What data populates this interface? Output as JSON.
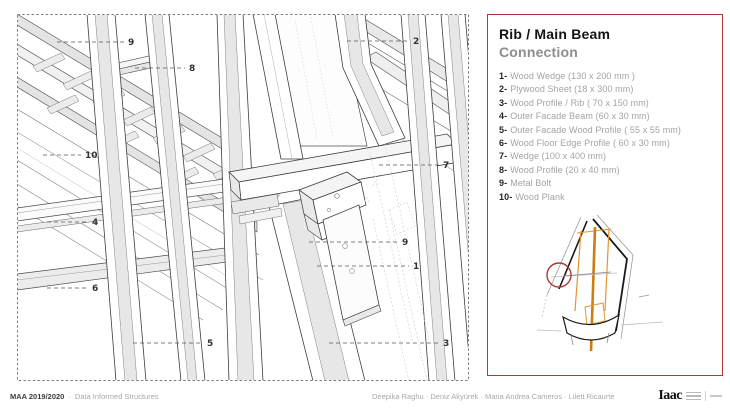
{
  "colors": {
    "accent_red": "#ae3a34",
    "orange": "#e2952f",
    "orange_dark": "#cf7d12"
  },
  "drawing": {
    "callouts": [
      {
        "label": "9",
        "x": 111,
        "y": 28,
        "leader_from": 40
      },
      {
        "label": "8",
        "x": 172,
        "y": 54,
        "leader_from": 118
      },
      {
        "label": "2",
        "x": 396,
        "y": 27,
        "leader_from": 330
      },
      {
        "label": "10",
        "x": 68,
        "y": 141,
        "leader_from": 26
      },
      {
        "label": "7",
        "x": 426,
        "y": 151,
        "leader_from": 362
      },
      {
        "label": "4",
        "x": 75,
        "y": 208,
        "leader_from": 30
      },
      {
        "label": "6",
        "x": 75,
        "y": 274,
        "leader_from": 30
      },
      {
        "label": "5",
        "x": 190,
        "y": 329,
        "leader_from": 116
      },
      {
        "label": "9",
        "x": 385,
        "y": 228,
        "leader_from": 292
      },
      {
        "label": "1",
        "x": 396,
        "y": 252,
        "leader_from": 300
      },
      {
        "label": "3",
        "x": 426,
        "y": 329,
        "leader_from": 312
      }
    ]
  },
  "panel": {
    "title_line1": "Rib / Main Beam",
    "title_line2": "Connection",
    "legend": [
      {
        "num": "1-",
        "text": "Wood Wedge (130 x 200 mm )"
      },
      {
        "num": "2-",
        "text": "Plywood Sheet  (18 x 300 mm)"
      },
      {
        "num": "3-",
        "text": "Wood Profile / Rib ( 70 x 150 mm)"
      },
      {
        "num": "4-",
        "text": "Outer Facade Beam (60 x 30 mm)"
      },
      {
        "num": "5-",
        "text": "Outer Facade Wood Profile ( 55 x 55 mm)"
      },
      {
        "num": "6-",
        "text": "Wood Floor Edge Profile ( 60 x 30 mm)"
      },
      {
        "num": "7-",
        "text": "Wedge (100 x 400 mm)"
      },
      {
        "num": "8-",
        "text": "Wood Profile (20 x 40 mm)"
      },
      {
        "num": "9-",
        "text": "Metal Bolt"
      },
      {
        "num": "10-",
        "text": "Wood Plank"
      }
    ]
  },
  "footer": {
    "program": "MAA 2019/2020",
    "separator": "·",
    "course": "Data Informed Structures",
    "credits": "Deepika Raghu · Deniz Akyürek · Maria Andrea Cameros · Lilett Ricaurte",
    "logo_text": "Iaac"
  }
}
